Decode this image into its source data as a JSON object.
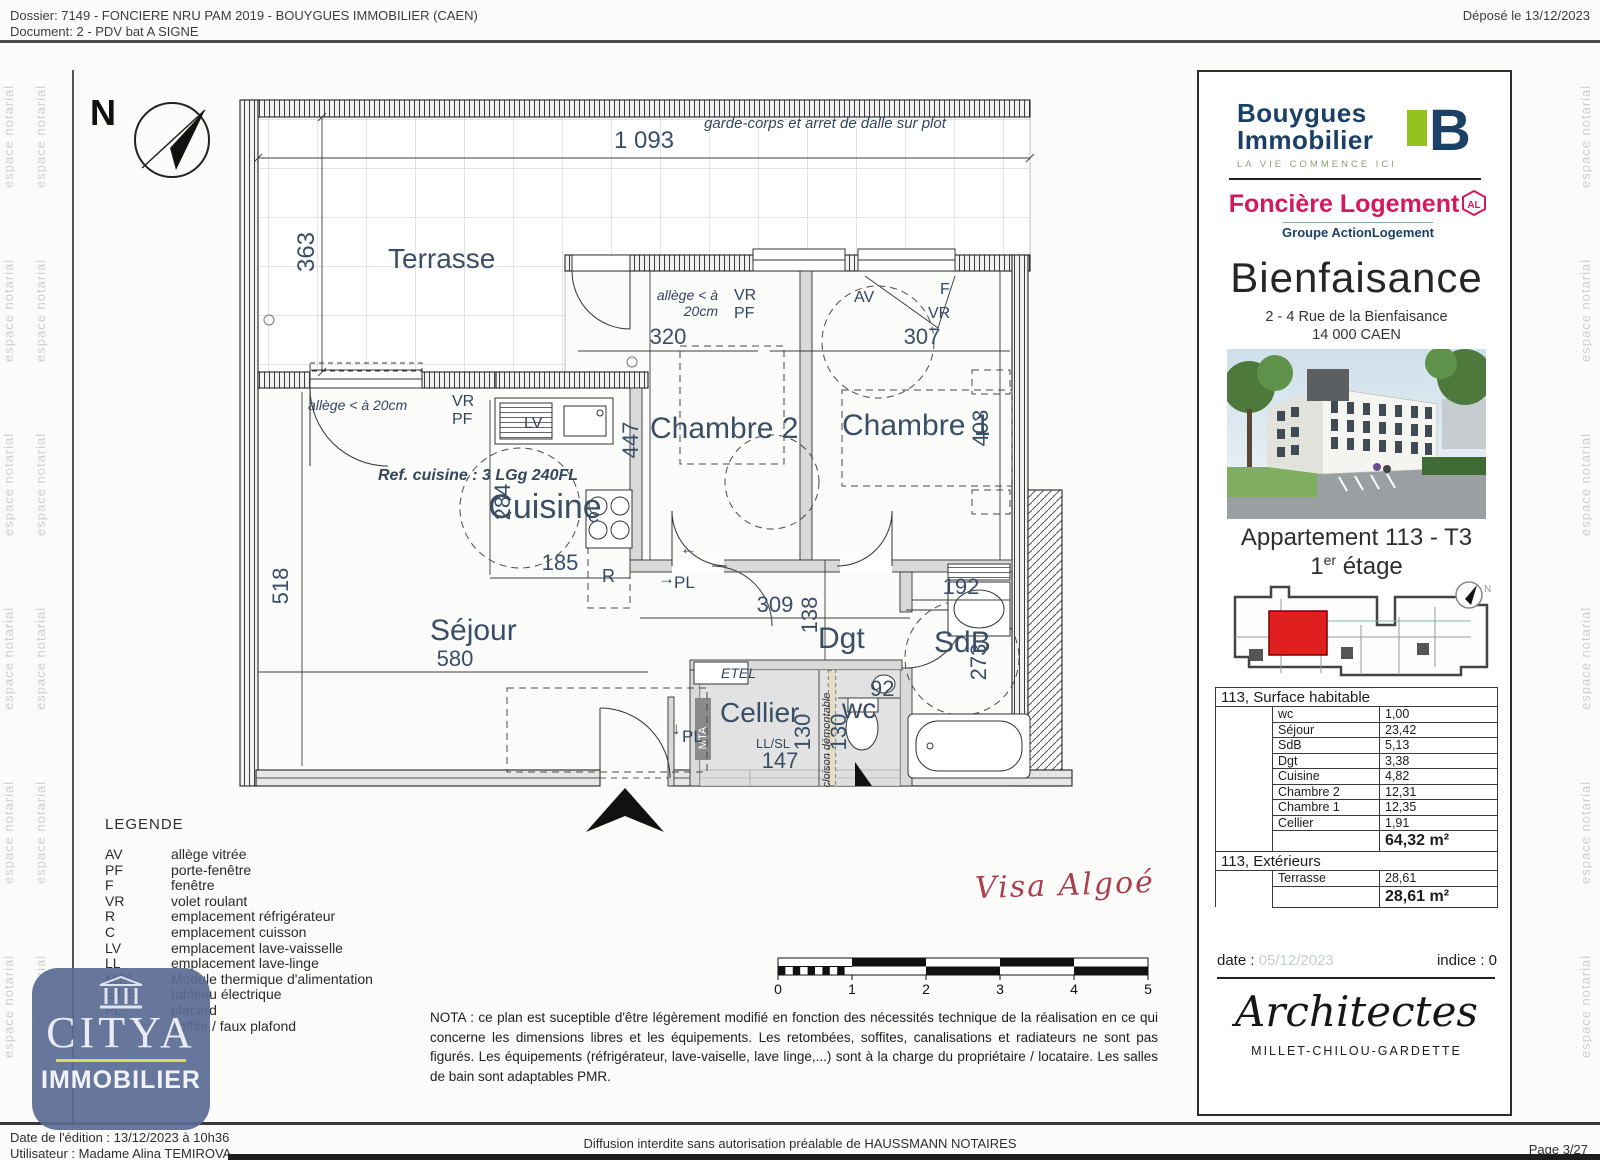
{
  "header": {
    "dossier": "Dossier: 7149 - FONCIERE NRU PAM 2019 - BOUYGUES IMMOBILIER (CAEN)",
    "document": "Document: 2 - PDV bat A SIGNE",
    "deposited": "Déposé le 13/12/2023"
  },
  "watermark": "espace notarial",
  "plan": {
    "north": "N",
    "garde_corps": "garde-corps et arret de dalle sur plot",
    "rooms": {
      "terrasse": "Terrasse",
      "cuisine": "Cuisine",
      "chambre2": "Chambre 2",
      "chambre1": "Chambre 1",
      "sejour": "Séjour",
      "dgt": "Dgt",
      "sdb": "SdB",
      "cellier": "Cellier",
      "wc": "wc"
    },
    "ann": {
      "allege1a": "allège < à",
      "allege1b": "20cm",
      "allege2": "allège < à 20cm",
      "vr": "VR",
      "pf": "PF",
      "av": "AV",
      "f": "F",
      "ref_cuisine": "Ref. cuisine : 3 LGg 240FL",
      "r": "R",
      "c": "C",
      "lv": "LV",
      "pl": "PL",
      "pl_arrow": "→",
      "pl_down": "↓",
      "arrow_left": "←",
      "etel": "ETEL",
      "mta": "MTA",
      "llsl": "LL/SL",
      "cloison": "cloison démontable"
    },
    "dims": {
      "d1093": "1 093",
      "d363": "363",
      "d320": "320",
      "d307": "307",
      "d447": "447",
      "d403": "403",
      "d284": "284",
      "d185": "185",
      "d518": "518",
      "d580": "580",
      "d309": "309",
      "d138": "138",
      "d192": "192",
      "d273": "273",
      "d130a": "130",
      "d130b": "130",
      "d147": "147",
      "d92": "92"
    }
  },
  "legend": {
    "title": "LEGENDE",
    "items": [
      {
        "abbr": "AV",
        "label": "allège vitrée"
      },
      {
        "abbr": "PF",
        "label": "porte-fenêtre"
      },
      {
        "abbr": "F",
        "label": "fenêtre"
      },
      {
        "abbr": "VR",
        "label": "volet roulant"
      },
      {
        "abbr": "R",
        "label": "emplacement réfrigérateur"
      },
      {
        "abbr": "C",
        "label": "emplacement cuisson"
      },
      {
        "abbr": "LV",
        "label": "emplacement lave-vaisselle"
      },
      {
        "abbr": "LL",
        "label": "emplacement lave-linge"
      },
      {
        "abbr": "MTA",
        "label": "Module thermique d'alimentation"
      },
      {
        "abbr": "ETEL",
        "label": "tableau électrique"
      },
      {
        "abbr": "PL",
        "label": "placard"
      },
      {
        "abbr": "",
        "label": "soffite / faux plafond"
      }
    ]
  },
  "nota": "NOTA : ce plan est suceptible d'être légèrement modifié en fonction des nécessités technique de la réalisation en ce qui concerne les dimensions libres et les équipements. Les retombées, soffites, canalisations et radiateurs ne sont pas figurés. Les équipements (réfrigérateur, lave-vaiselle, lave linge,...) sont à la charge du propriétaire / locataire. Les salles de bain sont adaptables PMR.",
  "visa": "Visa Algoé",
  "scale": {
    "ticks": [
      "0",
      "1",
      "2",
      "3",
      "4",
      "5"
    ]
  },
  "sidebar": {
    "bouygues1": "Bouygues",
    "bouygues2": "Immobilier",
    "bouygues_b": "B",
    "tagline": "LA VIE COMMENCE ICI",
    "fonciere": "Foncière Logement",
    "al": "AL",
    "groupe": "Groupe ActionLogement",
    "project": "Bienfaisance",
    "address1": "2 - 4 Rue de la Bienfaisance",
    "address2": "14 000 CAEN",
    "apt_title": "Appartement 113 - T3",
    "floor_num": "1",
    "floor_sup": "er",
    "floor_word": " étage",
    "locator_north": "N",
    "table": {
      "hab_header": "113, Surface habitable",
      "rows": [
        [
          "wc",
          "1,00"
        ],
        [
          "Séjour",
          "23,42"
        ],
        [
          "SdB",
          "5,13"
        ],
        [
          "Dgt",
          "3,38"
        ],
        [
          "Cuisine",
          "4,82"
        ],
        [
          "Chambre 2",
          "12,31"
        ],
        [
          "Chambre 1",
          "12,35"
        ],
        [
          "Cellier",
          "1,91"
        ]
      ],
      "hab_total": "64,32 m²",
      "ext_header": "113, Extérieurs",
      "ext_rows": [
        [
          "Terrasse",
          "28,61"
        ]
      ],
      "ext_total": "28,61 m²"
    },
    "date_label": "date :",
    "date_value": "05/12/2023",
    "indice": "indice : 0",
    "architects": "Architectes",
    "firm": "MILLET-CHILOU-GARDETTE"
  },
  "citya": {
    "name": "CITYA",
    "sub": "IMMOBILIER"
  },
  "footer": {
    "edition": "Date de l'édition : 13/12/2023 à 10h36",
    "user": "Utilisateur : Madame Alina TEMIROVA",
    "diffusion": "Diffusion interdite sans autorisation préalable de HAUSSMANN NOTAIRES",
    "page": "Page 3/27"
  },
  "colors": {
    "navy": "#1b4066",
    "green": "#93c11e",
    "magenta": "#d41a5e",
    "plan_text": "#3a4e66",
    "citya_blue": "#5a6b94",
    "visa_red": "#a8404e"
  }
}
